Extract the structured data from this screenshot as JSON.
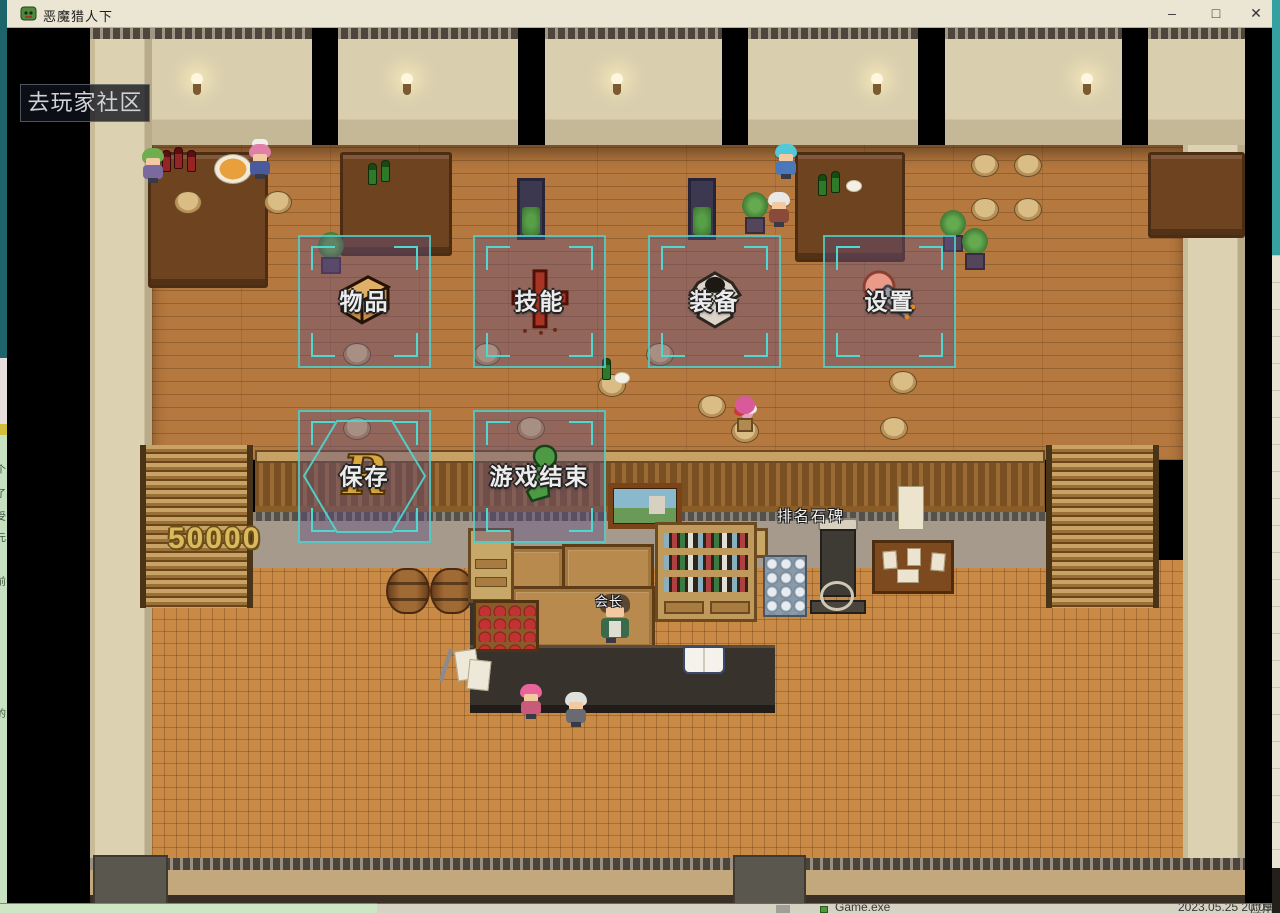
{
  "window": {
    "title": "恶魔猎人下",
    "controls": {
      "minimize": "–",
      "maximize": "□",
      "close": "✕"
    }
  },
  "hud": {
    "community_button_label": "去玩家社区",
    "gold_amount": "50000"
  },
  "menu": {
    "accent_color": "#4fd8cf",
    "fill_color": "rgba(98,78,130,0.42)",
    "buttons": [
      {
        "id": "items",
        "label": "物品",
        "icon": "chest-icon"
      },
      {
        "id": "skills",
        "label": "技能",
        "icon": "cross-icon"
      },
      {
        "id": "equipment",
        "label": "装备",
        "icon": "armor-icon"
      },
      {
        "id": "settings",
        "label": "设置",
        "icon": "hammer-icon"
      },
      {
        "id": "save",
        "label": "保存",
        "icon": "rune-icon"
      },
      {
        "id": "game_end",
        "label": "游戏结束",
        "icon": "figure-icon"
      }
    ]
  },
  "scene": {
    "monument_label": "排名石碑",
    "npc_label": "会长"
  },
  "desktop": {
    "file_row": {
      "name": "Game.exe",
      "modified": "2023.05.25 20:09",
      "type": "应用程序"
    },
    "chat_fragments": [
      "个",
      "了",
      "受",
      "元",
      "前",
      "的"
    ]
  },
  "colors": {
    "titlebar": "#ebe5d3",
    "gold_text": "#d9b95c",
    "desktop_teal": "#2a8f96"
  }
}
